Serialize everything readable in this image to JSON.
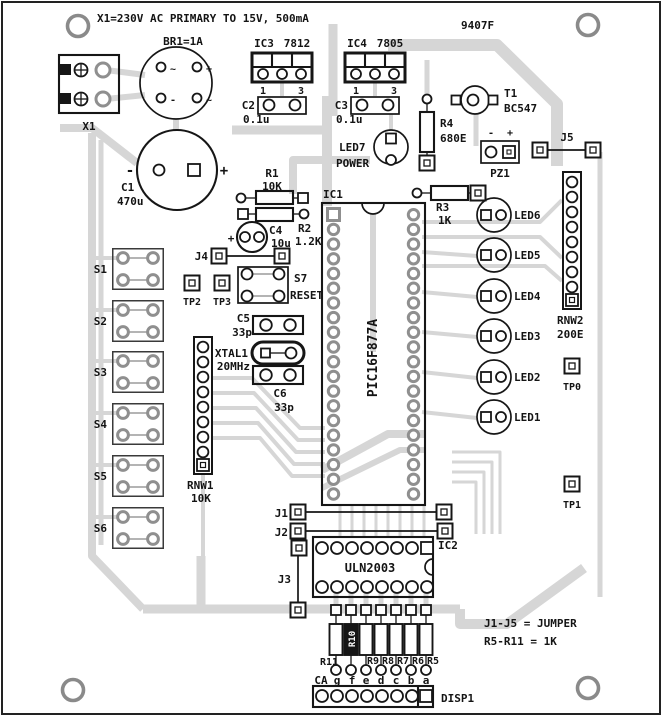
{
  "board": {
    "top_note": "X1=230V AC PRIMARY TO 15V, 500mA",
    "code": "9407F",
    "note_jumpers": "J1-J5 = JUMPER",
    "note_resistors": "R5-R11 = 1K"
  },
  "power": {
    "x1": "X1",
    "br1": "BR1=1A",
    "br1_tl": "~",
    "br1_tr": "+",
    "br1_bl": "-",
    "br1_br": "~",
    "ic3_ref": "IC3",
    "ic3_part": "7812",
    "ic3_pin1": "1",
    "ic3_pin3": "3",
    "ic4_ref": "IC4",
    "ic4_part": "7805",
    "ic4_pin1": "1",
    "ic4_pin3": "3",
    "c2_ref": "C2",
    "c2_val": "0.1u",
    "c3_ref": "C3",
    "c3_val": "0.1u",
    "c1_ref": "C1",
    "c1_val": "470u",
    "c1_minus": "-",
    "c1_plus": "+",
    "t1_ref": "T1",
    "t1_part": "BC547",
    "r4_ref": "R4",
    "r4_val": "680E",
    "led7_ref": "LED7",
    "led7_caption": "POWER",
    "pz1_ref": "PZ1",
    "pz1_minus": "-",
    "pz1_plus": "+",
    "j5": "J5"
  },
  "mcu": {
    "ic1_ref": "IC1",
    "ic1_part": "PIC16F877A",
    "r1_ref": "R1",
    "r1_val": "10K",
    "r2_ref": "R2",
    "r2_val": "1.2K",
    "r3_ref": "R3",
    "r3_val": "1K",
    "c4_ref": "C4",
    "c4_val": "10u",
    "c4_plus": "+",
    "j4": "J4",
    "tp2": "TP2",
    "tp3": "TP3",
    "s7_ref": "S7",
    "s7_caption": "RESET",
    "c5_ref": "C5",
    "c5_val": "33p",
    "xtal_ref": "XTAL1",
    "xtal_val": "20MHz",
    "c6_ref": "C6",
    "c6_val": "33p"
  },
  "switches": {
    "s1": "S1",
    "s2": "S2",
    "s3": "S3",
    "s4": "S4",
    "s5": "S5",
    "s6": "S6",
    "rnw1_ref": "RNW1",
    "rnw1_val": "10K"
  },
  "leds": {
    "led6": "LED6",
    "led5": "LED5",
    "led4": "LED4",
    "led3": "LED3",
    "led2": "LED2",
    "led1": "LED1",
    "rnw2_ref": "RNW2",
    "rnw2_val": "200E",
    "tp0": "TP0",
    "tp1": "TP1"
  },
  "driver": {
    "j1": "J1",
    "j2": "J2",
    "j3": "J3",
    "ic2_ref": "IC2",
    "ic2_part": "ULN2003",
    "r11": "R11",
    "r10": "R10",
    "r9": "R9",
    "r8": "R8",
    "r7": "R7",
    "r6": "R6",
    "r5": "R5",
    "seg_ca": "CA",
    "seg_g": "g",
    "seg_f": "f",
    "seg_e": "e",
    "seg_d": "d",
    "seg_c": "c",
    "seg_b": "b",
    "seg_a": "a",
    "disp1": "DISP1"
  },
  "colors": {
    "trace": "#d6d6d6",
    "pad_gray": "#8f8f8f",
    "ink": "#161616",
    "background": "#ffffff"
  }
}
